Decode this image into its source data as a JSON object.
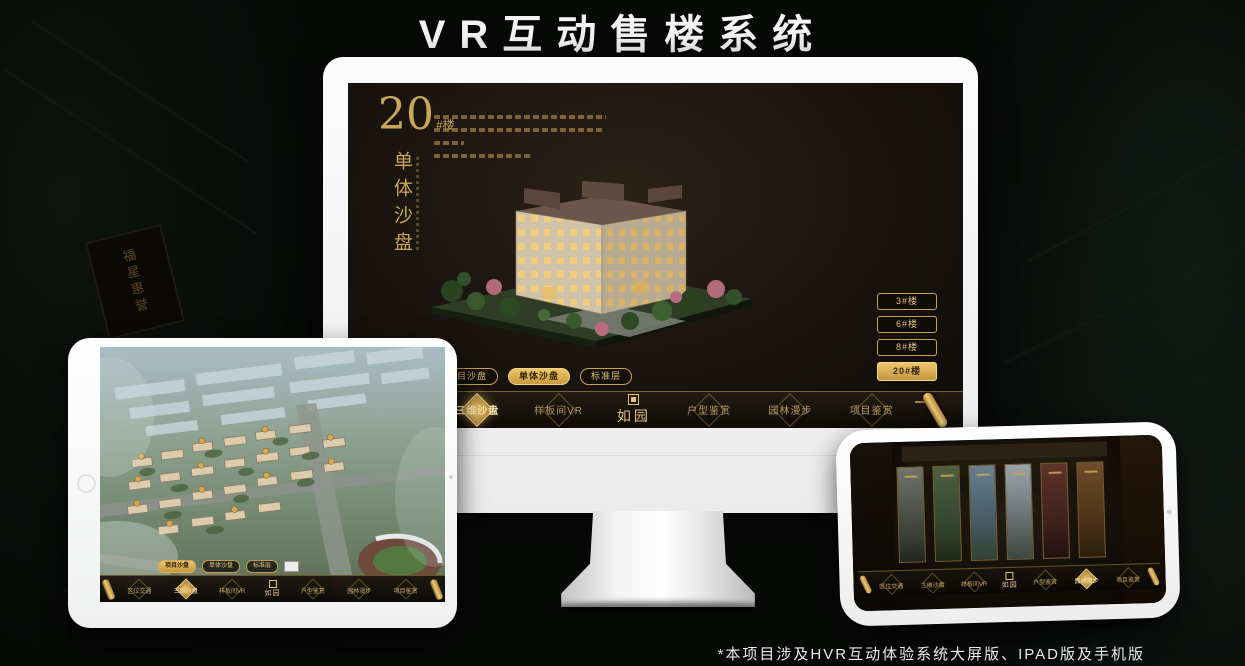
{
  "header": {
    "title": "VR互动售楼系统"
  },
  "footnote": "*本项目涉及HVR互动体验系统大屏版、IPAD版及手机版",
  "background": {
    "plaque_text": "福星惠誉"
  },
  "nav_menu": {
    "items": [
      "区位交通",
      "三维沙盘",
      "样板间VR",
      "户型鉴赏",
      "园林漫步",
      "项目鉴赏"
    ],
    "logo": "如园"
  },
  "monitor": {
    "headline": {
      "number": "20",
      "suffix": "#楼",
      "vertical": "单体沙盘"
    },
    "floor_buttons": [
      {
        "label": "3#楼",
        "active": false
      },
      {
        "label": "6#楼",
        "active": false
      },
      {
        "label": "8#楼",
        "active": false
      },
      {
        "label": "20#楼",
        "active": true
      }
    ],
    "mode_tabs": [
      {
        "label": "项目沙盘",
        "active": false
      },
      {
        "label": "单体沙盘",
        "active": true
      },
      {
        "label": "标准层",
        "active": false
      }
    ],
    "nav_active": "三维沙盘"
  },
  "tablet": {
    "mode_tabs": [
      {
        "label": "项目沙盘",
        "active": true
      },
      {
        "label": "单体沙盘",
        "active": false
      },
      {
        "label": "标准层",
        "active": false
      }
    ],
    "nav_active": "三维沙盘"
  },
  "phone": {
    "nav_active": "园林漫步",
    "panel_count": 6
  },
  "colors": {
    "gold": "#caa24e",
    "gold_bright": "#eec56a",
    "screen_bg": "#1b1510",
    "page_bg": "#070907"
  }
}
